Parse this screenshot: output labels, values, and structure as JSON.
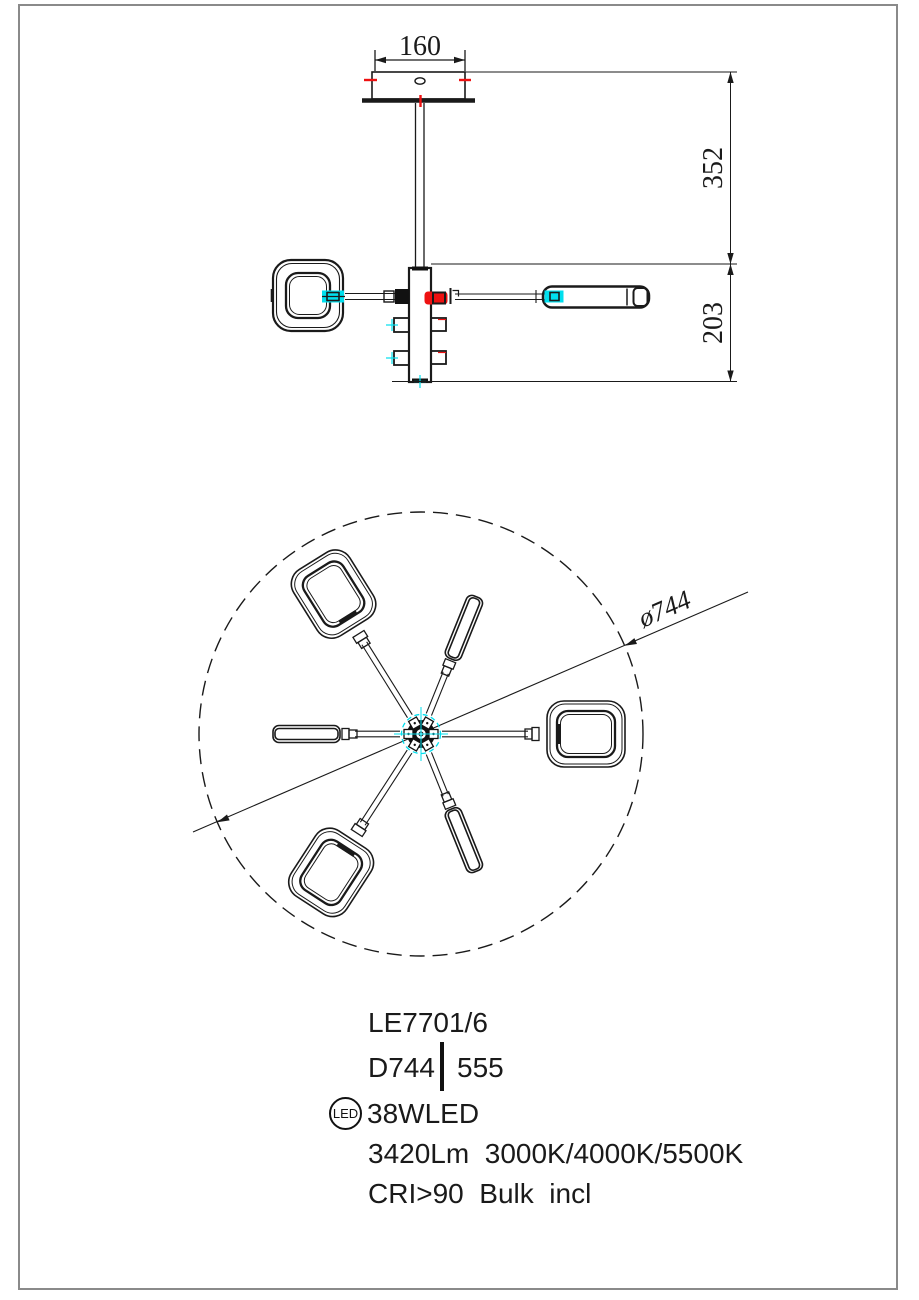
{
  "drawing": {
    "dimensions": {
      "canopy_width": "160",
      "drop_upper": "352",
      "drop_lower": "203",
      "diameter": "ø744"
    },
    "colors": {
      "line": "#1a1a1a",
      "accent_cyan": "#00dfee",
      "accent_red": "#ee1111",
      "frame_gray": "#8a8a8a"
    },
    "product": {
      "model": "LE7701/6",
      "diameter_label": "D744",
      "height_label": "555",
      "led_badge": "LED",
      "wattage": "38WLED",
      "lumens_line": "3420Lm  3000K/4000K/5500K",
      "cri_line": "CRI>90  Bulk  incl"
    }
  }
}
